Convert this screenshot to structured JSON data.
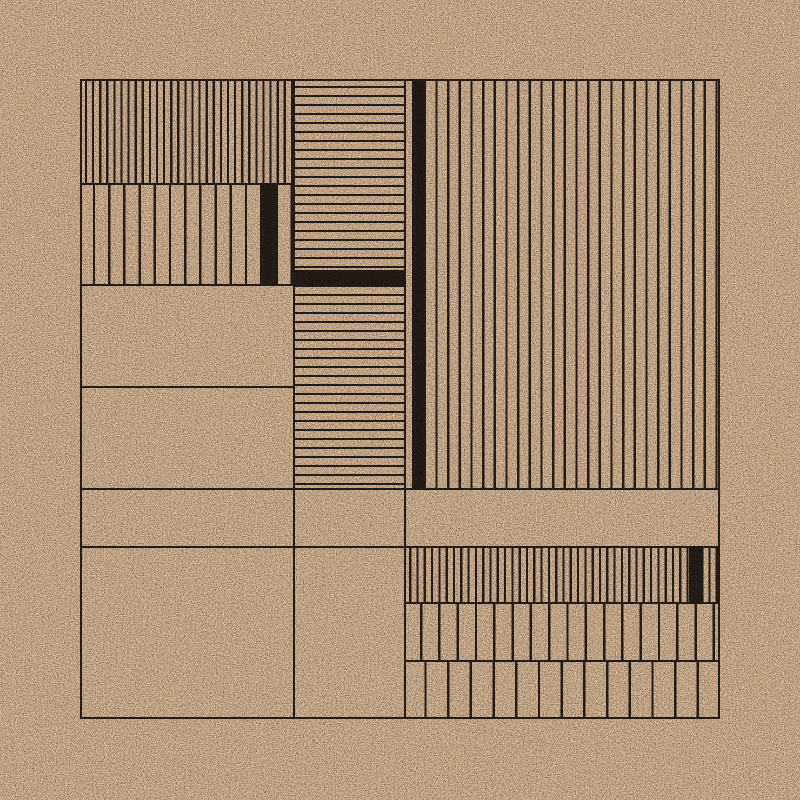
{
  "artwork": {
    "colors": {
      "background": "#ebc7a2",
      "line": "#2c241e",
      "solid_fill": "#2b221b"
    },
    "canvas": {
      "x": 80,
      "y": 79,
      "width": 640,
      "height": 640
    },
    "line_width": 2.4,
    "panels": [
      {
        "name": "panel-left-dense-vertical",
        "x": 0,
        "y": 0,
        "w": 213,
        "h": 104,
        "pattern": "vertical",
        "period": 7.1,
        "line": 2.2,
        "gap": 4.9,
        "fills": []
      },
      {
        "name": "panel-left-wide-vertical",
        "x": 0,
        "y": 104,
        "w": 213,
        "h": 101,
        "pattern": "vertical",
        "period": 15.2,
        "line": 2.4,
        "gap": 12.8,
        "fills": [
          {
            "x": 180.2,
            "w": 17.6
          }
        ]
      },
      {
        "name": "panel-left-empty-1",
        "x": 0,
        "y": 205,
        "w": 213,
        "h": 102,
        "pattern": "empty"
      },
      {
        "name": "panel-left-empty-2",
        "x": 0,
        "y": 307,
        "w": 213,
        "h": 102,
        "pattern": "empty"
      },
      {
        "name": "panel-left-empty-3",
        "x": 0,
        "y": 409,
        "w": 213,
        "h": 58,
        "pattern": "empty"
      },
      {
        "name": "panel-left-empty-4",
        "x": 0,
        "y": 467,
        "w": 213,
        "h": 173,
        "pattern": "empty"
      },
      {
        "name": "panel-middle-hlines-upper",
        "x": 213,
        "y": 0,
        "w": 111,
        "h": 191,
        "pattern": "horizontal",
        "period": 9,
        "line": 2.2,
        "gap": 6.8,
        "fills": []
      },
      {
        "name": "panel-middle-solid-band",
        "x": 213,
        "y": 191,
        "w": 111,
        "h": 17,
        "pattern": "solid"
      },
      {
        "name": "panel-middle-hlines-lower",
        "x": 213,
        "y": 208,
        "w": 111,
        "h": 201,
        "pattern": "horizontal",
        "period": 9,
        "line": 2.2,
        "gap": 6.8,
        "fills": []
      },
      {
        "name": "panel-middle-empty-1",
        "x": 213,
        "y": 409,
        "w": 111,
        "h": 58,
        "pattern": "empty"
      },
      {
        "name": "panel-middle-empty-2",
        "x": 213,
        "y": 467,
        "w": 111,
        "h": 173,
        "pattern": "empty"
      },
      {
        "name": "panel-right-tall-vertical",
        "x": 324,
        "y": 0,
        "w": 316,
        "h": 409,
        "pattern": "vertical",
        "period": 11.67,
        "line": 2.3,
        "gap": 8,
        "fills": [
          {
            "x": 8,
            "w": 14
          }
        ]
      },
      {
        "name": "panel-right-empty",
        "x": 324,
        "y": 409,
        "w": 316,
        "h": 58,
        "pattern": "empty"
      },
      {
        "name": "panel-right-dense-vertical",
        "x": 324,
        "y": 467,
        "w": 316,
        "h": 56,
        "pattern": "vertical",
        "period": 7.3,
        "line": 2.2,
        "gap": 5.1,
        "fills": [
          {
            "x": 284.7,
            "w": 14.6
          }
        ]
      },
      {
        "name": "panel-right-medium-vertical",
        "x": 324,
        "y": 523,
        "w": 316,
        "h": 58,
        "pattern": "vertical",
        "period": 18.3,
        "line": 2.4,
        "gap": 15.9,
        "fills": []
      },
      {
        "name": "panel-right-wide-vertical",
        "x": 324,
        "y": 581,
        "w": 316,
        "h": 59,
        "pattern": "vertical",
        "period": 22.7,
        "line": 2.4,
        "gap": 20.3,
        "fills": []
      }
    ],
    "grid_lines": {
      "vertical_full": [
        0,
        213,
        324,
        637.6
      ],
      "horizontal_full": [
        0,
        409,
        467,
        637.6
      ],
      "horizontal_left_column": [
        104,
        205,
        307
      ],
      "horizontal_right_column": [
        523,
        581
      ]
    },
    "grain": {
      "base_frequency": 0.9,
      "dark_tint": "#8a4f28",
      "dark_opacity": 0.38,
      "light_tint": "#fff3e0",
      "light_opacity": 0.45
    }
  }
}
